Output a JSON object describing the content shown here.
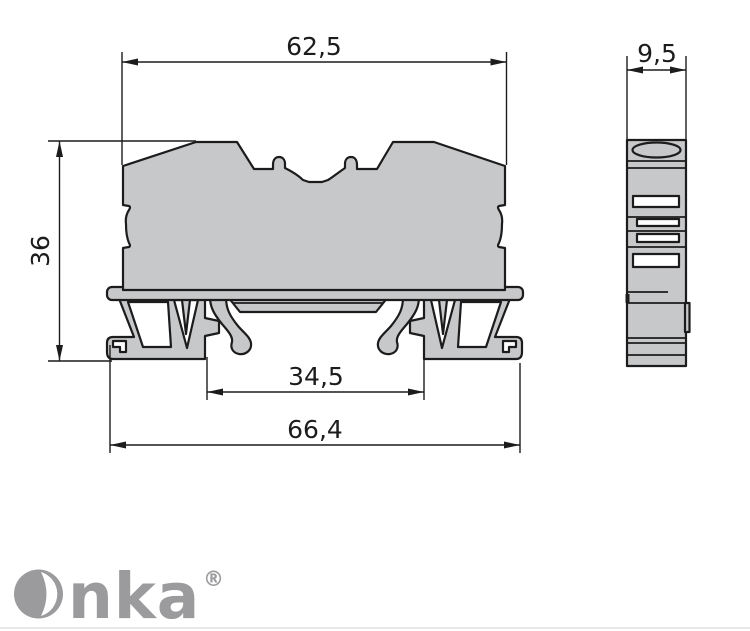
{
  "page": {
    "background_color": "#ffffff",
    "bottom_rule_color": "#e9e9e9"
  },
  "drawing": {
    "type": "technical-dimension-drawing",
    "subject": "terminal block profile with DIN-rail foot, front section and side view",
    "line_color": "#1c1c1c",
    "part_fill_color": "#c7c8ca",
    "front_view": {
      "dim_top_width": "62,5",
      "dim_height": "36",
      "dim_rail_span": "34,5",
      "dim_overall_width": "66,4"
    },
    "side_view": {
      "dim_thickness": "9,5"
    }
  },
  "logo": {
    "name": "Onka",
    "text_part": "nka",
    "registered_mark": "®",
    "color": "#9b9b9e"
  }
}
